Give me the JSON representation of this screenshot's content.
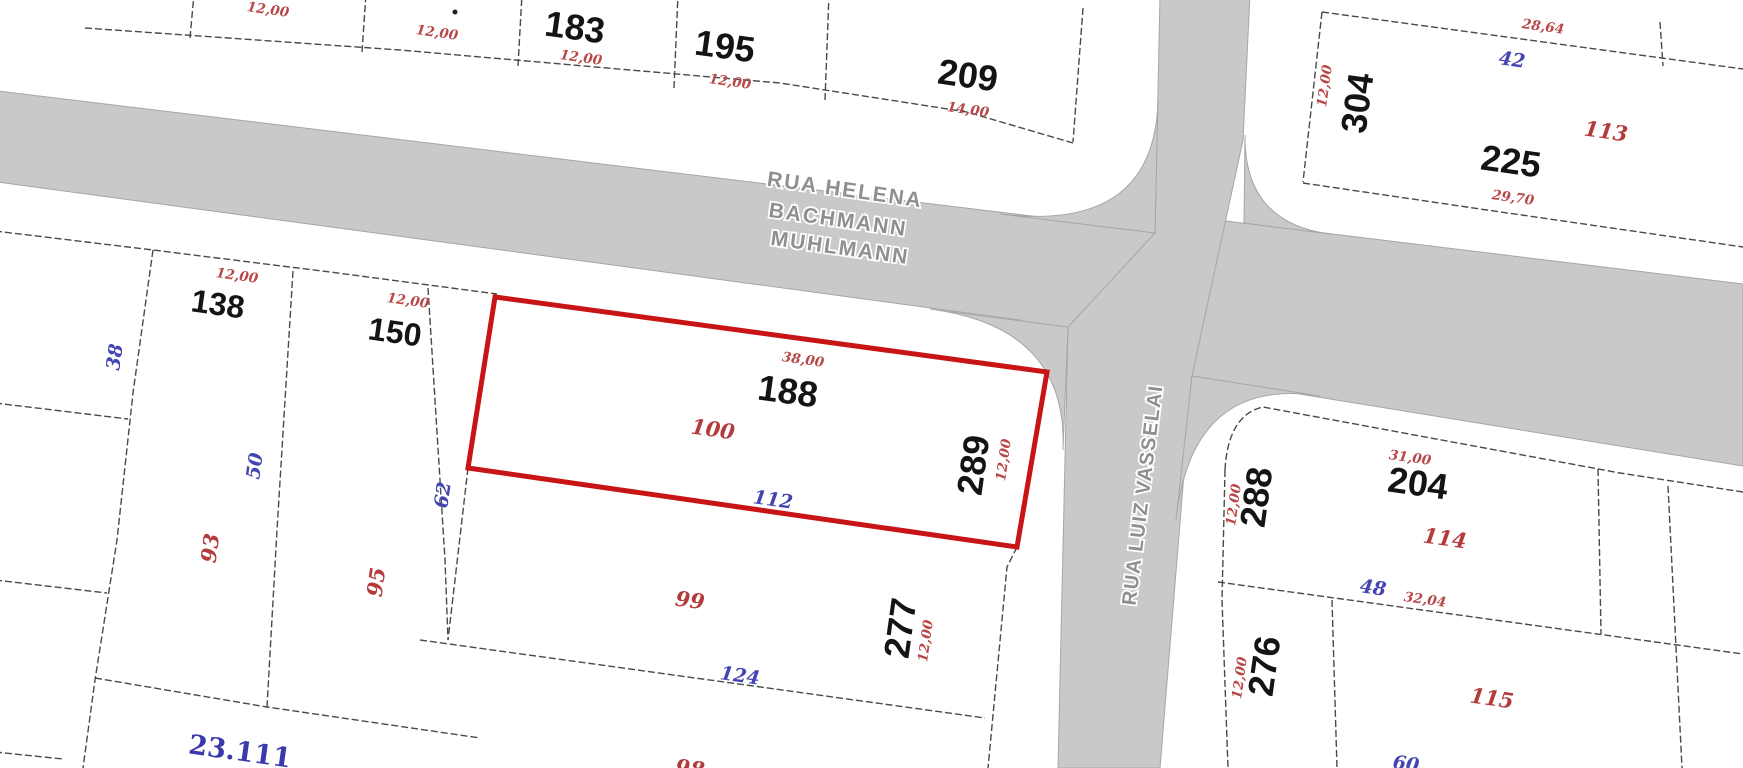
{
  "map": {
    "type": "cadastral-plat",
    "streets": {
      "horizontal_line1": "RUA HELENA",
      "horizontal_line2": "BACHMANN",
      "horizontal_line3": "MUHLMANN",
      "vertical": "RUA LUIZ VASSELAI"
    },
    "colors": {
      "highlight_outline": "#c81414",
      "road_fill": "#c9c9c9",
      "boundary_line": "#4a4a4a",
      "dimension_red": "#b84848",
      "reference_blue": "#4444b2",
      "lot_number_black": "#141414",
      "street_text_gray": "#8f8f8f"
    },
    "top_left_block": {
      "dim_a": "12,00",
      "dim_b": "12,00",
      "lot183": "183",
      "lot183_dim": "12,00",
      "lot195": "195",
      "lot195_dim": "12,00",
      "lot209": "209",
      "lot209_dim": "14,00"
    },
    "top_right_block": {
      "lot304": "304",
      "lot304_dim": "12,00",
      "top_dim": "28,64",
      "ref_blue": "42",
      "red_serif": "113",
      "lot225": "225",
      "bottom_dim": "29,70"
    },
    "main_block": {
      "lot138": "138",
      "lot138_dim": "12,00",
      "lot150": "150",
      "lot150_dim": "12,00",
      "highlighted_lot": "188",
      "highlighted_top_dim": "38,00",
      "highlighted_area": "100",
      "highlighted_corner_lot": "289",
      "highlighted_side_dim": "12,00",
      "highlighted_bottom_ref": "112",
      "left_ref_38": "38",
      "left_ref_50": "50",
      "left_ref_62": "62",
      "left_red_93": "93",
      "left_red_95": "95",
      "mid_red_99": "99",
      "mid_ref_124": "124",
      "lot277": "277",
      "lot277_dim": "12,00",
      "corner_big_blue": "23.111",
      "bottom_cut_red": "98"
    },
    "southeast_block": {
      "lot288": "288",
      "lot288_dim": "12,00",
      "top_dim": "31,00",
      "lot204": "204",
      "red_114": "114",
      "ref_48": "48",
      "dim_3204": "32,04",
      "lot276": "276",
      "lot276_dim": "12,00",
      "red_115": "115",
      "ref_60_cut": "60"
    }
  }
}
